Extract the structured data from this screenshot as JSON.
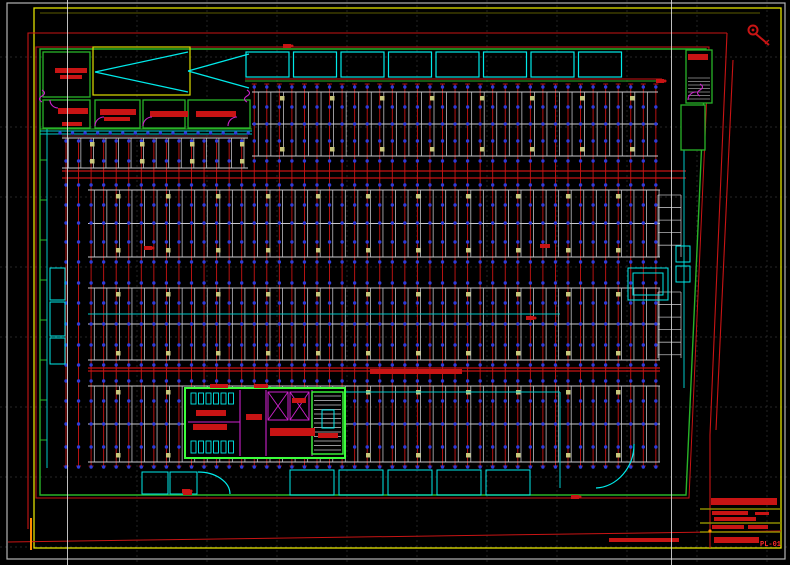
{
  "meta": {
    "type": "CAD floor plan drawing",
    "sheet_label": "PL-01"
  },
  "drawing": {
    "colors": {
      "bg": "#000000",
      "grid": "#3a3a3a",
      "fold": "#e0e0e0",
      "sheet_border": "#c8c8c8",
      "yellow": "#e0e000",
      "olive": "#8a8a00",
      "red": "#c81414",
      "dark_red": "#8c1a1a",
      "maroon": "#7a2a2a",
      "green": "#28b428",
      "lime": "#3cff3c",
      "cyan": "#00c8c8",
      "bright_cyan": "#00eaea",
      "magenta": "#cc22cc",
      "blue": "#2e3cdc",
      "khaki": "#c8c87c",
      "white_line": "#c9c9cd",
      "gray": "#9a9a9a",
      "orange": "#ff8c00"
    },
    "grid": {
      "v": [
        137,
        207,
        277,
        347,
        417,
        487,
        557,
        627,
        697,
        767
      ],
      "h": [
        57,
        127,
        197,
        267,
        337,
        407,
        477,
        547
      ],
      "fold": [
        67.5,
        671.5
      ]
    },
    "sheet": {
      "outer": [
        7,
        3,
        778,
        556
      ],
      "yellow": [
        34,
        8,
        747,
        540
      ],
      "yellow2": [
        40,
        13,
        760,
        13
      ]
    },
    "site": {
      "paths": [
        "M28,529 V33 H727",
        "M727,33 L710,435 L710,548",
        "M733,60 L716,430"
      ],
      "road": [
        8,
        542,
        781,
        531
      ]
    },
    "building": {
      "green": "M40,495 V49 H706 L686,495 Z",
      "red": "M36,498 V47 H709 L689,498 Z",
      "top2": {
        "red": [
          245,
          79,
          662,
          79
        ],
        "green": [
          245,
          81,
          662,
          81
        ]
      },
      "corridor": {
        "cyan": [
          [
            40,
            131,
            252,
            131
          ],
          [
            40,
            134,
            252,
            134
          ]
        ],
        "green": [
          40,
          129,
          252,
          129
        ],
        "maroon": [
          62,
          136,
          248,
          136
        ]
      },
      "left_ticks": {
        "x0": 40,
        "x1": 47,
        "ys": [
          160,
          200,
          240,
          280,
          320,
          360,
          400,
          440
        ]
      }
    },
    "pipes": {
      "x0": 66,
      "x1": 659,
      "step": 12.55,
      "y_top": 84,
      "y_top_left": 138,
      "left_cut": 250,
      "y_bot": 466,
      "main": [
        [
          62,
          171,
          686,
          171
        ],
        [
          62,
          178,
          686,
          178
        ],
        [
          88,
          368,
          660,
          368
        ],
        [
          88,
          371,
          660,
          371
        ]
      ]
    },
    "dots": {
      "rows": [
        87,
        107,
        124,
        141,
        161,
        185,
        205,
        223,
        242,
        262,
        283,
        303,
        324,
        345,
        365,
        381,
        401,
        424,
        447,
        467
      ],
      "corridor_y": 133,
      "corridor_x0": 60,
      "corridor_x1": 250
    },
    "bands": [
      {
        "x0": 252,
        "x1": 658,
        "y0": 92,
        "y1": 156,
        "rows": 2
      },
      {
        "x0": 62,
        "x1": 248,
        "y0": 138,
        "y1": 168,
        "rows": 1
      },
      {
        "x0": 88,
        "x1": 660,
        "y0": 190,
        "y1": 257,
        "rows": 2
      },
      {
        "x0": 88,
        "x1": 660,
        "y0": 288,
        "y1": 360,
        "rows": 2
      },
      {
        "x0": 88,
        "x1": 660,
        "y0": 386,
        "y1": 462,
        "rows": 2
      }
    ],
    "right_stalls": {
      "x0": 658,
      "x1": 681,
      "step": 12.55,
      "segments": [
        [
          195,
          257
        ],
        [
          292,
          358
        ]
      ]
    },
    "khaki": {
      "size": 4.5,
      "step": 50,
      "offset": 28
    },
    "cyan": {
      "lines": [
        [
          47,
          129,
          47,
          468
        ],
        [
          88,
          314,
          560,
          314
        ],
        [
          345,
          392,
          560,
          392
        ],
        [
          560,
          392,
          560,
          488
        ],
        [
          684,
          150,
          684,
          388
        ]
      ],
      "rects": [
        [
          142,
          472,
          26,
          22
        ],
        [
          170,
          472,
          27,
          22
        ],
        [
          50,
          268,
          15,
          32
        ],
        [
          50,
          302,
          15,
          34
        ],
        [
          50,
          338,
          15,
          26
        ],
        [
          628,
          268,
          40,
          32
        ],
        [
          633,
          273,
          30,
          22
        ],
        [
          676,
          246,
          14,
          16
        ],
        [
          676,
          266,
          14,
          16
        ],
        [
          692,
          62,
          9,
          13
        ]
      ],
      "paths": [
        "M198,472 a32,22 0 0 1 32,22",
        "M634,444 a40,44 0 0 1 -38,44"
      ],
      "top_bays": {
        "x0": 246,
        "y": 52,
        "w": 43,
        "h": 25,
        "step": 47.5,
        "count": 8
      },
      "bottom_bays": {
        "x0": 290,
        "y": 470,
        "w": 44,
        "h": 25,
        "step": 49,
        "count": 5
      }
    },
    "magenta": {
      "paths": [
        "M95,126 a9,9 0 0 1 9,-9",
        "M143,126 a9,9 0 0 1 9,-9",
        "M228,126 a9,9 0 0 1 9,-9",
        "M50,100 a8,8 0 0 0 8,8",
        "M688,100 a8,8 0 0 1 8,-8",
        "M42,90 q5,3 0,6 q-5,3 0,6",
        "M247,90 q5,3 0,6 q-5,3 0,6",
        "M700,84 q5,3 0,6 q-5,3 0,6"
      ],
      "core_lines": [
        [
          240,
          390,
          240,
          456
        ],
        [
          266,
          390,
          266,
          456
        ],
        [
          312,
          390,
          312,
          456
        ],
        [
          188,
          422,
          240,
          422
        ]
      ],
      "xboxes": [
        [
          268,
          392,
          20,
          28
        ],
        [
          290,
          392,
          19,
          28
        ]
      ]
    },
    "core": {
      "frame": [
        185,
        388,
        160,
        70
      ],
      "stair": [
        312,
        392,
        31,
        62
      ],
      "treads": {
        "x0": 314,
        "x1": 341,
        "y0": 396,
        "y1": 450,
        "step": 4.5
      },
      "combs": [
        {
          "x0": 191,
          "y": 393,
          "n": 6,
          "w": 5,
          "h": 11,
          "gap": 2.5
        },
        {
          "x0": 191,
          "y": 441,
          "n": 6,
          "w": 5,
          "h": 12,
          "gap": 2.5
        }
      ],
      "red_bars": [
        [
          196,
          410,
          30,
          6
        ],
        [
          193,
          424,
          34,
          6
        ],
        [
          246,
          414,
          16,
          6
        ],
        [
          270,
          428,
          45,
          8
        ],
        [
          292,
          398,
          14,
          5
        ],
        [
          210,
          384,
          18,
          4
        ],
        [
          254,
          384,
          14,
          4
        ],
        [
          318,
          433,
          20,
          5
        ]
      ],
      "lift": [
        322,
        410,
        12,
        18
      ]
    },
    "rooms": {
      "green_rects": [
        [
          43,
          52,
          47,
          45
        ],
        [
          43,
          100,
          47,
          28
        ],
        [
          95,
          100,
          45,
          28
        ],
        [
          143,
          100,
          42,
          28
        ],
        [
          188,
          100,
          62,
          28
        ],
        [
          686,
          50,
          26,
          53
        ],
        [
          681,
          105,
          24,
          45
        ]
      ],
      "yellow_rect": [
        93,
        47,
        97,
        48
      ],
      "ramp_lines": [
        [
          95,
          72,
          188,
          52
        ],
        [
          95,
          72,
          188,
          92
        ],
        [
          188,
          71,
          249,
          54
        ],
        [
          188,
          71,
          249,
          88
        ]
      ],
      "tr_treads": {
        "x0": 688,
        "x1": 710,
        "y0": 78,
        "y1": 100,
        "step": 3.5
      },
      "red_bars": [
        [
          55,
          68,
          32,
          5
        ],
        [
          60,
          75,
          22,
          4
        ],
        [
          58,
          108,
          30,
          6
        ],
        [
          100,
          109,
          36,
          6
        ],
        [
          104,
          117,
          26,
          4
        ],
        [
          150,
          111,
          38,
          6
        ],
        [
          196,
          111,
          40,
          6
        ],
        [
          688,
          54,
          20,
          6
        ],
        [
          62,
          122,
          20,
          4
        ]
      ]
    },
    "annotations": {
      "bars": [
        [
          370,
          369,
          92,
          5
        ],
        [
          183,
          491,
          9,
          4
        ],
        [
          540,
          244,
          10,
          4
        ],
        [
          609,
          538,
          70,
          4
        ]
      ],
      "markers": [
        [
          148,
          248
        ],
        [
          287,
          46
        ],
        [
          530,
          318
        ],
        [
          186,
          491
        ],
        [
          575,
          497
        ],
        [
          660,
          81
        ]
      ]
    },
    "north": {
      "cx": 753,
      "cy": 30,
      "r": 4.5,
      "tail": [
        756,
        34,
        769,
        45
      ]
    },
    "title_block": {
      "olive_lines": [
        [
          700,
          509,
          781,
          509
        ],
        [
          700,
          523,
          781,
          523
        ],
        [
          700,
          532,
          781,
          532
        ]
      ],
      "red_bars": [
        [
          711,
          498,
          66,
          7
        ],
        [
          712,
          511,
          36,
          4
        ],
        [
          755,
          512,
          14,
          3
        ],
        [
          714,
          517,
          42,
          4
        ],
        [
          712,
          525,
          32,
          4
        ],
        [
          748,
          525,
          20,
          4
        ],
        [
          714,
          537,
          45,
          6
        ]
      ],
      "orange_dot": [
        710,
        531
      ],
      "orange_seg": [
        31,
        518,
        31,
        550
      ],
      "plan_label": "PL-01"
    }
  }
}
